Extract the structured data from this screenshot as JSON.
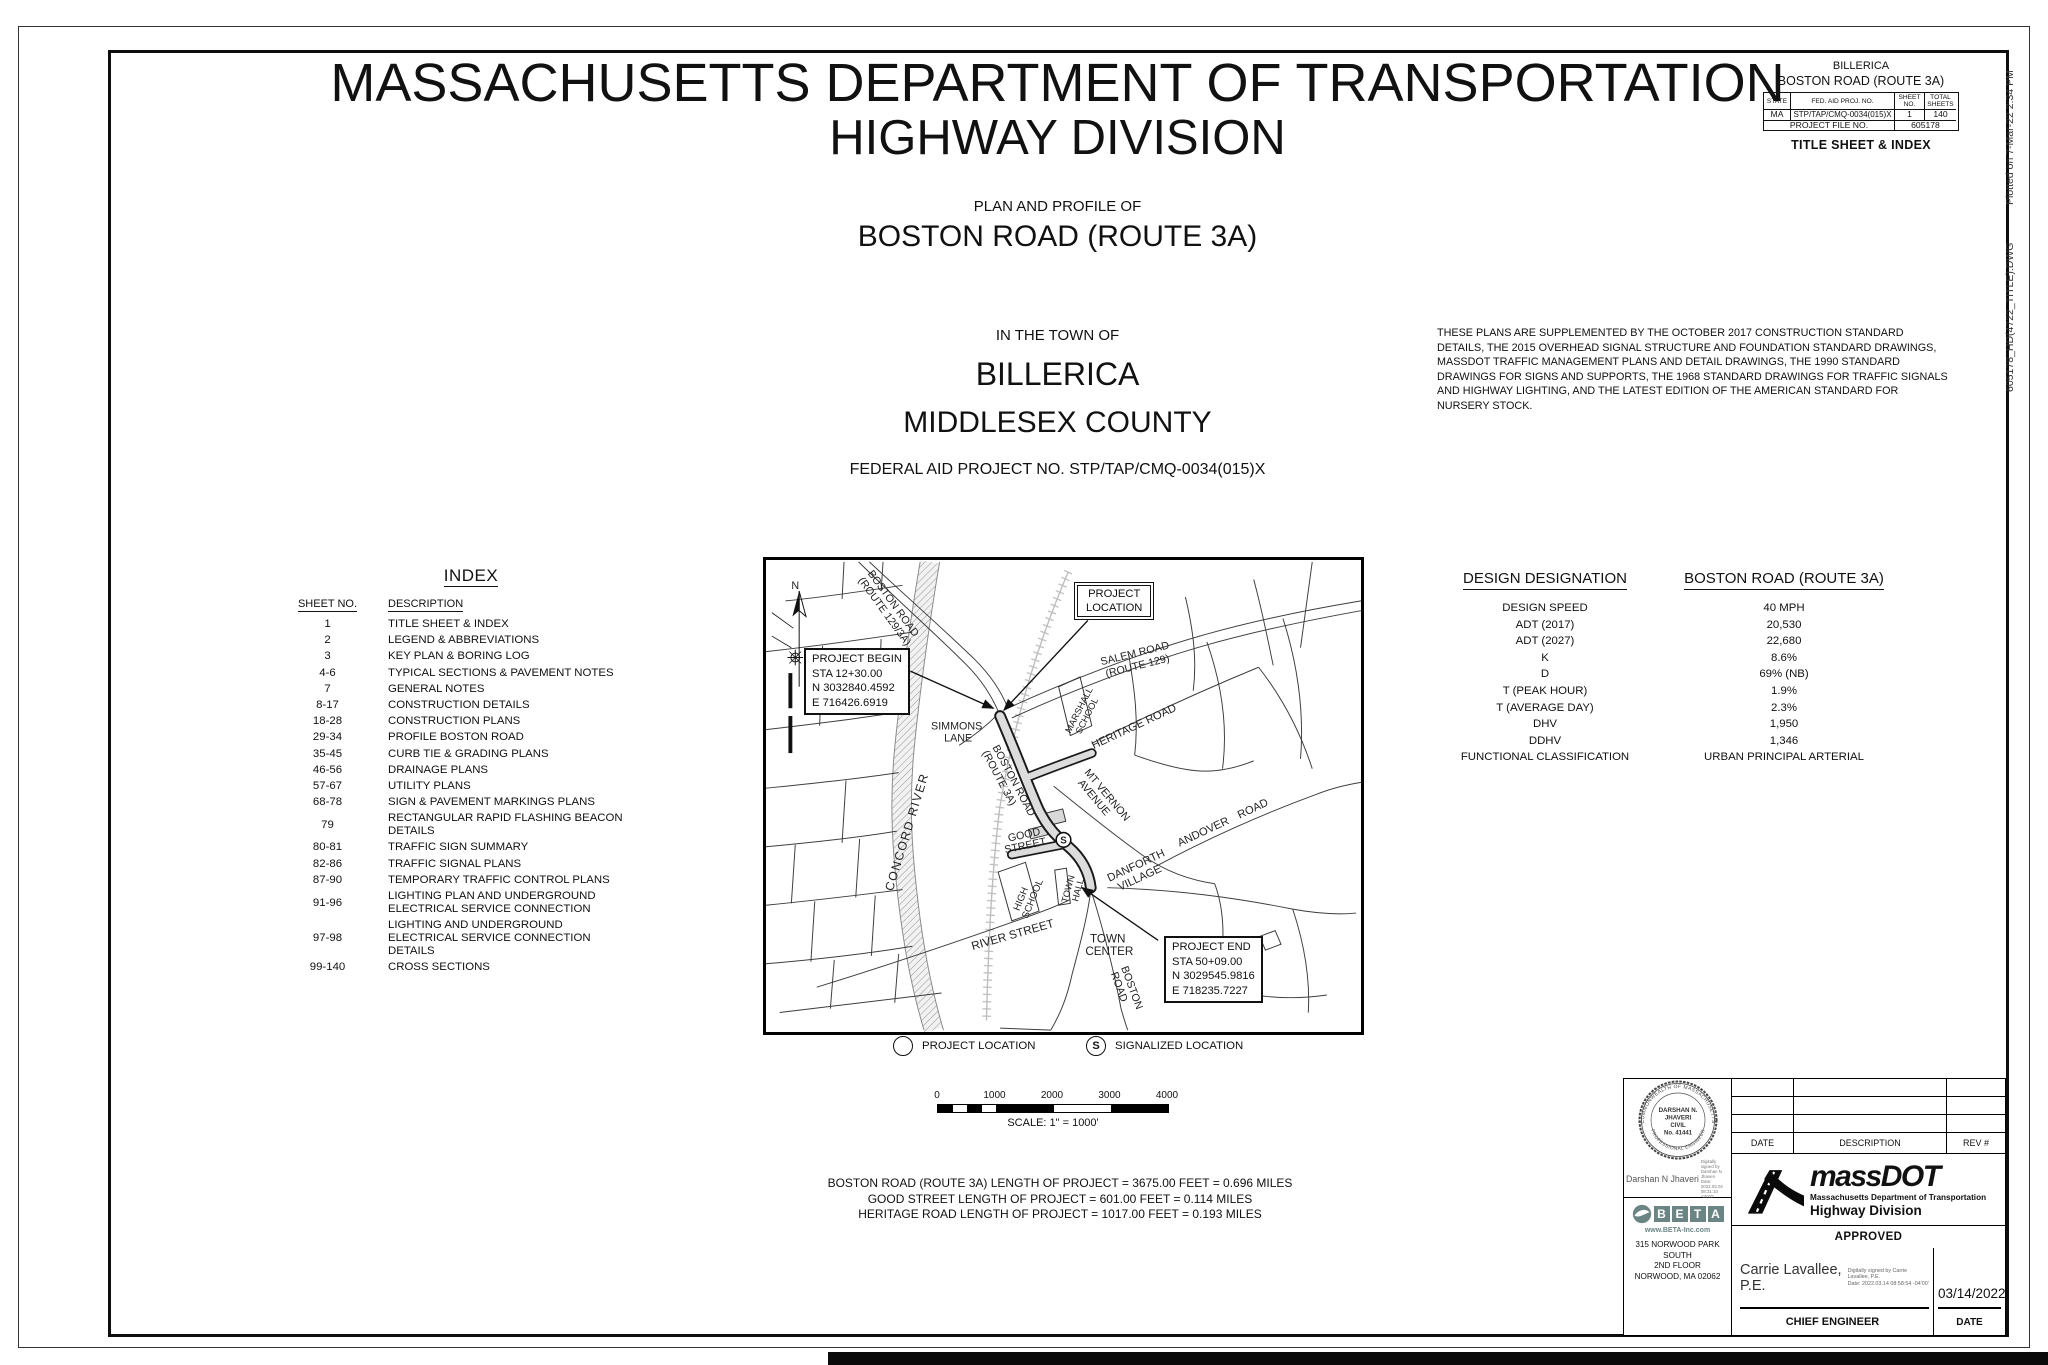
{
  "header": {
    "agency": "MASSACHUSETTS DEPARTMENT OF TRANSPORTATION",
    "division": "HIGHWAY DIVISION",
    "plan_type": "PLAN AND PROFILE OF",
    "road": "BOSTON ROAD (ROUTE 3A)",
    "in_town_of": "IN THE TOWN OF",
    "town": "BILLERICA",
    "county": "MIDDLESEX COUNTY",
    "federal_aid": "FEDERAL AID PROJECT NO. STP/TAP/CMQ-0034(015)X"
  },
  "corner_block": {
    "town": "BILLERICA",
    "road": "BOSTON ROAD (ROUTE 3A)",
    "col_state": "STATE",
    "col_fed_aid": "FED. AID PROJ. NO.",
    "col_sheet_no": "SHEET\nNO.",
    "col_total_sheets": "TOTAL\nSHEETS",
    "state": "MA",
    "fed_aid_no": "STP/TAP/CMQ-0034(015)X",
    "sheet_no": "1",
    "total_sheets": "140",
    "project_file_label": "PROJECT FILE NO.",
    "project_file_no": "605178",
    "sheet_title": "TITLE SHEET & INDEX"
  },
  "plot_stamp": {
    "file": "605178_HD(4722_TITLE).DWG",
    "plotted": "Plotted on  7-Mar-22  2:34 PM"
  },
  "notes": "THESE PLANS ARE SUPPLEMENTED BY THE OCTOBER 2017 CONSTRUCTION STANDARD DETAILS, THE 2015 OVERHEAD SIGNAL STRUCTURE AND FOUNDATION STANDARD DRAWINGS, MASSDOT TRAFFIC MANAGEMENT PLANS AND DETAIL DRAWINGS, THE 1990 STANDARD DRAWINGS FOR SIGNS AND SUPPORTS, THE 1968 STANDARD DRAWINGS FOR TRAFFIC SIGNALS AND HIGHWAY LIGHTING, AND THE LATEST EDITION OF THE AMERICAN STANDARD FOR NURSERY STOCK.",
  "index": {
    "title": "INDEX",
    "col_sheet": "SHEET NO.",
    "col_desc": "DESCRIPTION",
    "rows": [
      {
        "no": "1",
        "desc": "TITLE SHEET & INDEX"
      },
      {
        "no": "2",
        "desc": "LEGEND & ABBREVIATIONS"
      },
      {
        "no": "3",
        "desc": "KEY PLAN & BORING LOG"
      },
      {
        "no": "4-6",
        "desc": "TYPICAL SECTIONS & PAVEMENT NOTES"
      },
      {
        "no": "7",
        "desc": "GENERAL NOTES"
      },
      {
        "no": "8-17",
        "desc": "CONSTRUCTION DETAILS"
      },
      {
        "no": "18-28",
        "desc": "CONSTRUCTION PLANS"
      },
      {
        "no": "29-34",
        "desc": "PROFILE BOSTON ROAD"
      },
      {
        "no": "35-45",
        "desc": "CURB TIE & GRADING PLANS"
      },
      {
        "no": "46-56",
        "desc": "DRAINAGE PLANS"
      },
      {
        "no": "57-67",
        "desc": "UTILITY PLANS"
      },
      {
        "no": "68-78",
        "desc": "SIGN & PAVEMENT MARKINGS PLANS"
      },
      {
        "no": "79",
        "desc": "RECTANGULAR RAPID FLASHING BEACON DETAILS"
      },
      {
        "no": "80-81",
        "desc": "TRAFFIC SIGN SUMMARY"
      },
      {
        "no": "82-86",
        "desc": "TRAFFIC SIGNAL PLANS"
      },
      {
        "no": "87-90",
        "desc": "TEMPORARY TRAFFIC CONTROL PLANS"
      },
      {
        "no": "91-96",
        "desc": "LIGHTING PLAN AND UNDERGROUND ELECTRICAL SERVICE CONNECTION"
      },
      {
        "no": "97-98",
        "desc": "LIGHTING AND UNDERGROUND ELECTRICAL SERVICE CONNECTION DETAILS"
      },
      {
        "no": "99-140",
        "desc": "CROSS SECTIONS"
      }
    ]
  },
  "map": {
    "north": "N",
    "road_boston_129_3a": [
      "BOSTON ROAD",
      "(ROUTE 129/3A)"
    ],
    "road_salem": [
      "SALEM ROAD",
      "(ROUTE 129)"
    ],
    "road_heritage": "HERITAGE ROAD",
    "road_mt_vernon": [
      "MT VERNON",
      "AVENUE"
    ],
    "road_simmons": [
      "SIMMONS",
      "LANE"
    ],
    "road_boston_3a": [
      "BOSTON ROAD",
      "(ROUTE 3A)"
    ],
    "school_marshall": [
      "MARSHALL",
      "SCHOOL"
    ],
    "river_concord": "CONCORD RIVER",
    "road_good": [
      "GOOD",
      "STREET"
    ],
    "town_hall": [
      "TOWN",
      "HALL"
    ],
    "school_high": [
      "HIGH",
      "SCHOOL"
    ],
    "road_river": "RIVER STREET",
    "town_center": [
      "TOWN",
      "CENTER"
    ],
    "danforth_village": [
      "DANFORTH",
      "VILLAGE"
    ],
    "road_andover": "ANDOVER ROAD",
    "road_boston_bottom": [
      "BOSTON",
      "ROAD"
    ],
    "project_location": [
      "PROJECT",
      "LOCATION"
    ],
    "signal_symbol": "S",
    "project_begin": [
      "PROJECT BEGIN",
      "STA 12+30.00",
      "N 3032840.4592",
      "E 716426.6919"
    ],
    "project_end": [
      "PROJECT END",
      "STA 50+09.00",
      "N 3029545.9816",
      "E 718235.7227"
    ],
    "legend": {
      "location_label": "PROJECT LOCATION",
      "signal_label": "SIGNALIZED LOCATION",
      "signal_symbol": "S"
    }
  },
  "design": {
    "title": "DESIGN DESIGNATION",
    "road": "BOSTON ROAD (ROUTE 3A)",
    "rows": [
      {
        "label": "DESIGN SPEED",
        "value": "40 MPH"
      },
      {
        "label": "ADT (2017)",
        "value": "20,530"
      },
      {
        "label": "ADT (2027)",
        "value": "22,680"
      },
      {
        "label": "K",
        "value": "8.6%"
      },
      {
        "label": "D",
        "value": "69% (NB)"
      },
      {
        "label": "T (PEAK HOUR)",
        "value": "1.9%"
      },
      {
        "label": "T (AVERAGE DAY)",
        "value": "2.3%"
      },
      {
        "label": "DHV",
        "value": "1,950"
      },
      {
        "label": "DDHV",
        "value": "1,346"
      },
      {
        "label": "FUNCTIONAL CLASSIFICATION",
        "value": "URBAN PRINCIPAL ARTERIAL"
      }
    ]
  },
  "scale": {
    "ticks": [
      "0",
      "1000",
      "2000",
      "3000",
      "4000"
    ],
    "label": "SCALE: 1\" = 1000'"
  },
  "lengths": [
    "BOSTON ROAD (ROUTE 3A) LENGTH OF PROJECT = 3675.00 FEET = 0.696 MILES",
    "GOOD STREET LENGTH OF PROJECT = 601.00 FEET = 0.114 MILES",
    "HERITAGE ROAD LENGTH OF PROJECT = 1017.00 FEET = 0.193 MILES"
  ],
  "title_block": {
    "stamp": {
      "arc_top": "COMMONWEALTH OF MASSACHUSETTS",
      "name1": "DARSHAN N.",
      "name2": "JHAVERI",
      "discipline": "CIVIL",
      "number": "No. 41441",
      "arc_bottom": "PROFESSIONAL ENGINEER"
    },
    "signature1": {
      "name": "Darshan N Jhaveri",
      "digital": "Digitally signed by Darshan N\nJhaveri\nDate: 2022.03.04 08:31:10 -05'00'"
    },
    "beta": {
      "letters": [
        "B",
        "E",
        "T",
        "A"
      ],
      "url": "www.BETA-Inc.com",
      "address1": "315 NORWOOD PARK SOUTH",
      "address2": "2ND FLOOR",
      "address3": "NORWOOD, MA 02062"
    },
    "rev_table": {
      "date": "DATE",
      "description": "DESCRIPTION",
      "rev": "REV #"
    },
    "massdot": {
      "name": "massDOT",
      "line1": "Massachusetts Department of Transportation",
      "line2": "Highway Division"
    },
    "approved": "APPROVED",
    "signature2": {
      "name_line1": "Carrie Lavallee,",
      "name_line2": "P.E.",
      "digital": "Digitally signed by Carrie\nLavallee, P.E.\nDate: 2022.03.14 08:58:54 -04'00'",
      "date": "03/14/2022"
    },
    "chief_label": "CHIEF ENGINEER",
    "date_label": "DATE"
  }
}
